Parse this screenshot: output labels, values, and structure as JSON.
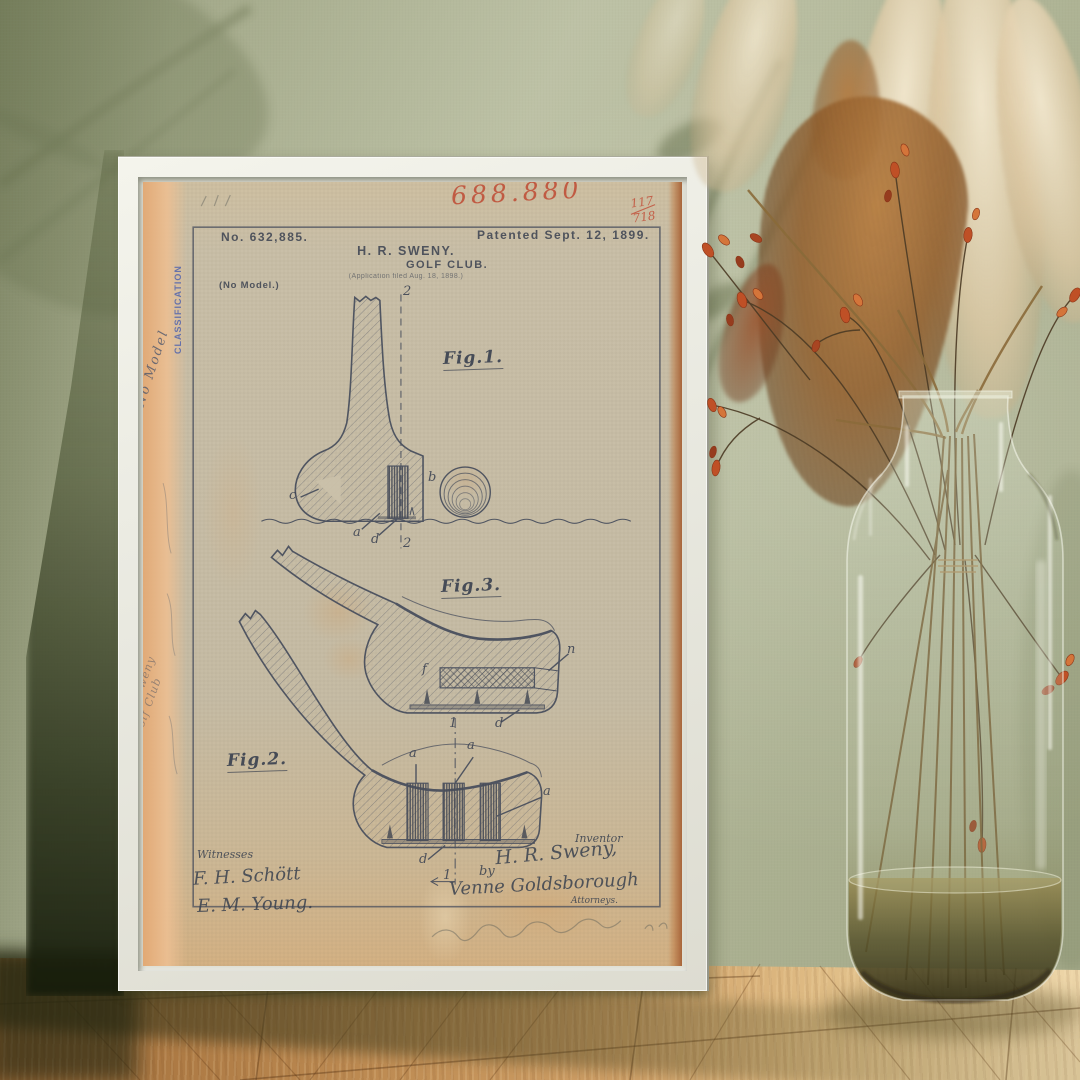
{
  "scene": {
    "wall_color": "#b4b99b",
    "floor_color_left": "#9c6a38",
    "floor_color_right": "#ead0a0",
    "frame_color": "#e9e9e0",
    "paper_color": "#c8bfa7",
    "accent_red": "#bf4a33",
    "stamp_blue": "#3b55b0",
    "ink_color": "#3e4553"
  },
  "patent": {
    "annotations": {
      "red_number": "688.880",
      "page_fraction_numerator": "117",
      "page_fraction_denominator": "718"
    },
    "header": {
      "patent_no": "No. 632,885.",
      "patented": "Patented Sept. 12, 1899.",
      "inventor_name": "H. R. SWENY.",
      "title": "GOLF CLUB.",
      "application": "(Application filed Aug. 18, 1898.)",
      "no_model": "(No Model.)"
    },
    "figures": {
      "fig1": "Fig.1.",
      "fig2": "Fig.2.",
      "fig3": "Fig.3."
    },
    "fig1_labels": {
      "sec_top": "2",
      "sec_bottom": "2",
      "a": "a",
      "b": "b",
      "c": "c",
      "d": "d"
    },
    "fig3_labels": {
      "f": "f",
      "n": "n",
      "one": "1",
      "d": "d"
    },
    "fig2_labels": {
      "a1": "a",
      "a2": "a",
      "a3": "a",
      "d": "d",
      "one": "1"
    },
    "signatures": {
      "witnesses_heading": "Witnesses",
      "witness_1": "F. H. Schött",
      "witness_2": "E. M. Young.",
      "inventor_heading": "Inventor",
      "inventor_signature": "H. R. Sweny,",
      "by_label": "by",
      "attorney_signature": "Venne Goldsborough",
      "attorneys_label": "Attorneys."
    },
    "margin": {
      "stamp": "CLASSIFICATION",
      "note_top": "No Model",
      "note_name": "H. R. Sweny",
      "note_title": "Golf Club"
    }
  }
}
